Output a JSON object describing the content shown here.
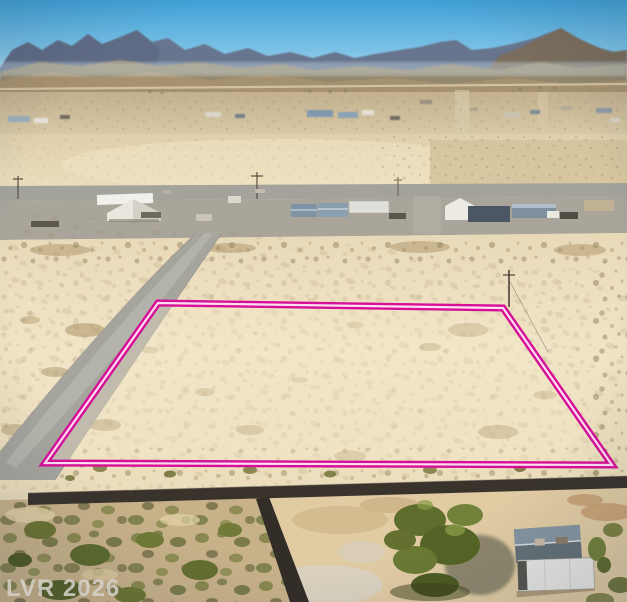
{
  "meta": {
    "type": "aerial-photograph",
    "description": "Drone aerial photo of a vacant desert land parcel outlined in magenta, in a rural desert community with a mountain range backdrop, paved cross street with scattered homes, dirt side road, block wall and a home with RV in the foreground",
    "width": 627,
    "height": 602
  },
  "watermark": {
    "text": "LVR 2026",
    "color": "#d6d2cb"
  },
  "parcel_overlay": {
    "shape": "quadrilateral",
    "corners": [
      [
        158,
        303
      ],
      [
        503,
        308
      ],
      [
        612,
        465
      ],
      [
        45,
        463
      ]
    ],
    "outer_stroke": "#d60f97",
    "inner_stroke": "#ffdef2"
  },
  "scene": {
    "sky_top": "#3f9fd4",
    "sky_horizon": "#c6e7f6",
    "mountains": "#66738e",
    "right_peak": "#7c6c55",
    "foothills": "#a7926f",
    "desert_far": "#c6b593",
    "desert_mid": "#e6d7b6",
    "desert_near": "#f2e5c7",
    "road_gray": "#a3a29b",
    "block_wall": "#39332c",
    "trees_green": "#556426",
    "landmarks": [
      "mountain range",
      "distant homes",
      "paved cross street",
      "diagonal dirt road",
      "vacant parcel outlined in magenta",
      "utility pole",
      "block wall",
      "house with metal roof",
      "white RV",
      "desert scrub"
    ]
  }
}
